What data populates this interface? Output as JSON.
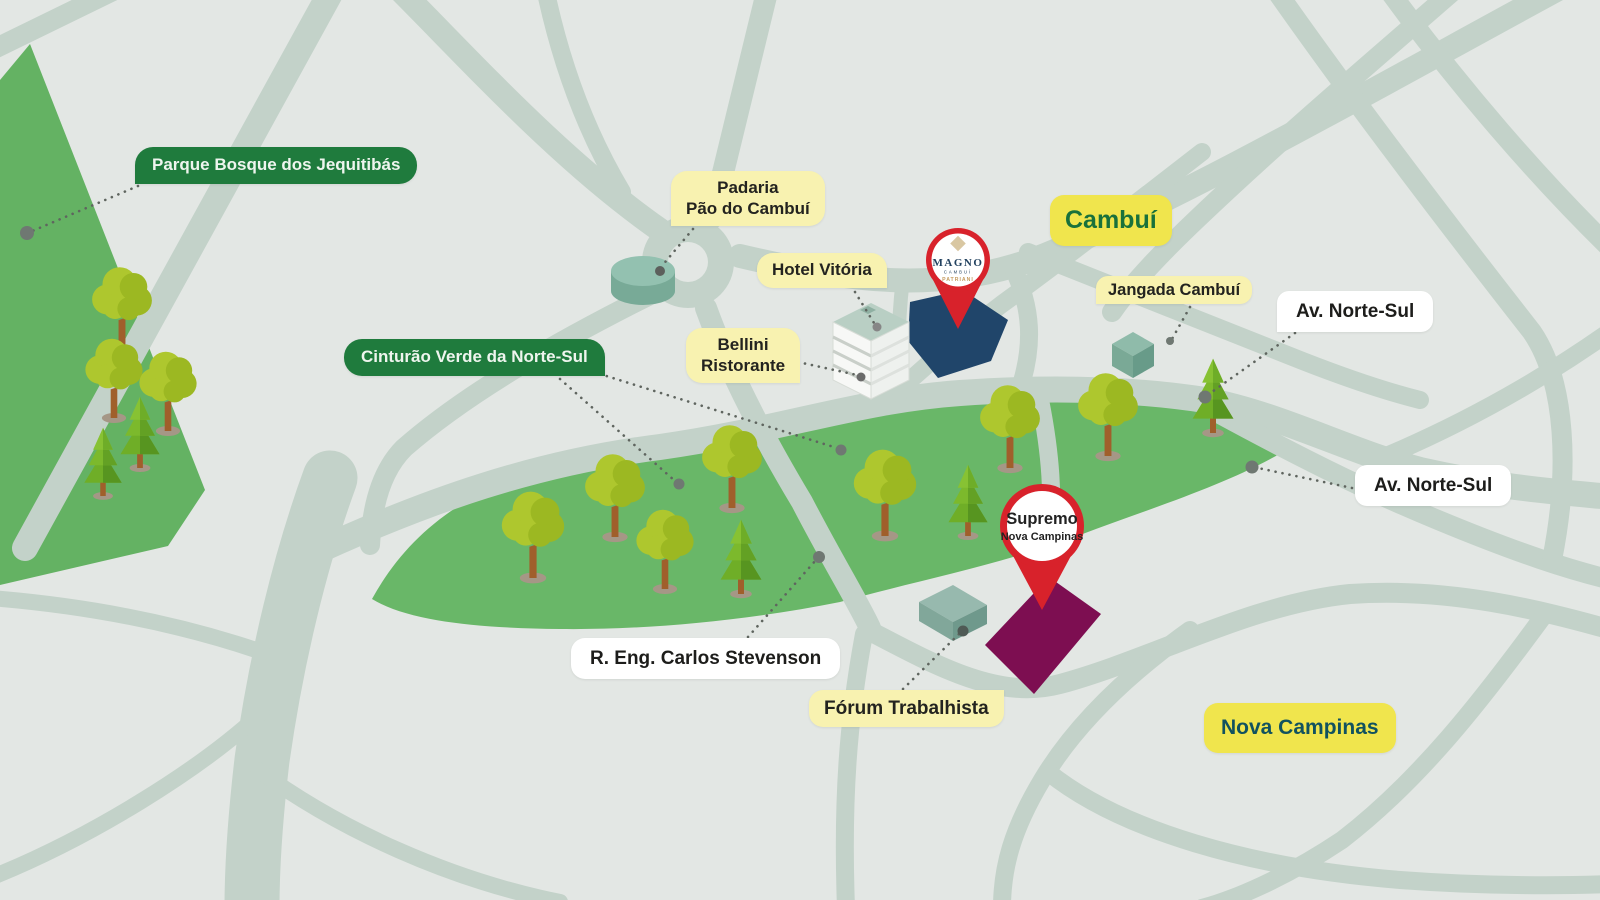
{
  "map": {
    "region_labels": {
      "cambui": "Cambuí",
      "nova_campinas": "Nova Campinas"
    },
    "green_area_labels": {
      "parque": "Parque Bosque dos Jequitibás",
      "cinturao": "Cinturão Verde da Norte-Sul"
    },
    "poi_labels": {
      "padaria_line1": "Padaria",
      "padaria_line2": "Pão do Cambuí",
      "hotel": "Hotel Vitória",
      "bellini_line1": "Bellini",
      "bellini_line2": "Ristorante",
      "jangada": "Jangada Cambuí",
      "forum": "Fórum Trabalhista"
    },
    "street_labels": {
      "av_norte_sul_north": "Av. Norte-Sul",
      "av_norte_sul_east": "Av. Norte-Sul",
      "stevenson": "R. Eng. Carlos Stevenson"
    },
    "pins": {
      "magno": {
        "brand": "MAGNO",
        "location": "CAMBUÍ",
        "developer": "PATRIANI"
      },
      "supremo": {
        "title": "Supremo",
        "subtitle": "Nova Campinas"
      }
    },
    "colors": {
      "background": "#e3e7e4",
      "road": "#c3d2c9",
      "green_area": "#69b768",
      "label_dark_green": "#1f7b3d",
      "label_bright_yellow": "#f0e54d",
      "label_pale_yellow": "#f8f2b0",
      "pin_red": "#d8222b",
      "magno_lot_navy": "#20456a",
      "supremo_lot_purple": "#7d0e51"
    }
  }
}
